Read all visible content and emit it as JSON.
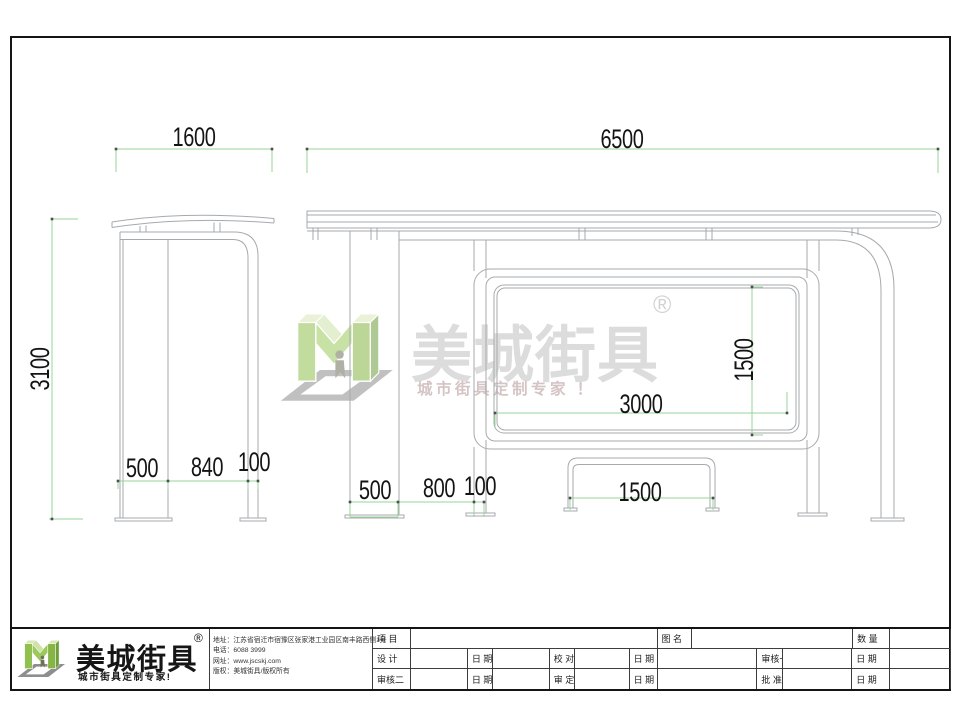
{
  "watermark": {
    "brand": "美城街具",
    "registered": "®",
    "tagline": "城市街具定制专家 ！"
  },
  "dimensions": {
    "side_width": "1600",
    "side_height": "3100",
    "side_leg_depth": "500",
    "side_gap": "840",
    "side_post": "100",
    "front_width": "6500",
    "front_wall_depth": "500",
    "front_gap": "800",
    "front_post": "100",
    "panel_width": "3000",
    "panel_height": "1500",
    "bench_width": "1500"
  },
  "footer": {
    "logo": {
      "brand": "美城街具",
      "registered": "®",
      "tagline": "城市街具定制专家!"
    },
    "contact": [
      {
        "label": "地址：",
        "value": "江苏省宿迁市宿豫区张家港工业园区南丰路西侧1号"
      },
      {
        "label": "电话：",
        "value": "6088 3999"
      },
      {
        "label": "网址：",
        "value": "www.jscskj.com"
      },
      {
        "label": "版权：",
        "value": "美城街具/版权所有"
      }
    ],
    "titleblock": {
      "row1": [
        "项 目",
        "图 名",
        "数 量"
      ],
      "row2": [
        "设 计",
        "日 期",
        "校 对",
        "日 期",
        "审核一",
        "日 期"
      ],
      "row3": [
        "审核二",
        "日 期",
        "审 定",
        "日 期",
        "批 准",
        "日 期"
      ]
    }
  },
  "colors": {
    "dimension_line": "#97d497",
    "object_line": "#a6aaae",
    "logo_green": "#92c050"
  }
}
